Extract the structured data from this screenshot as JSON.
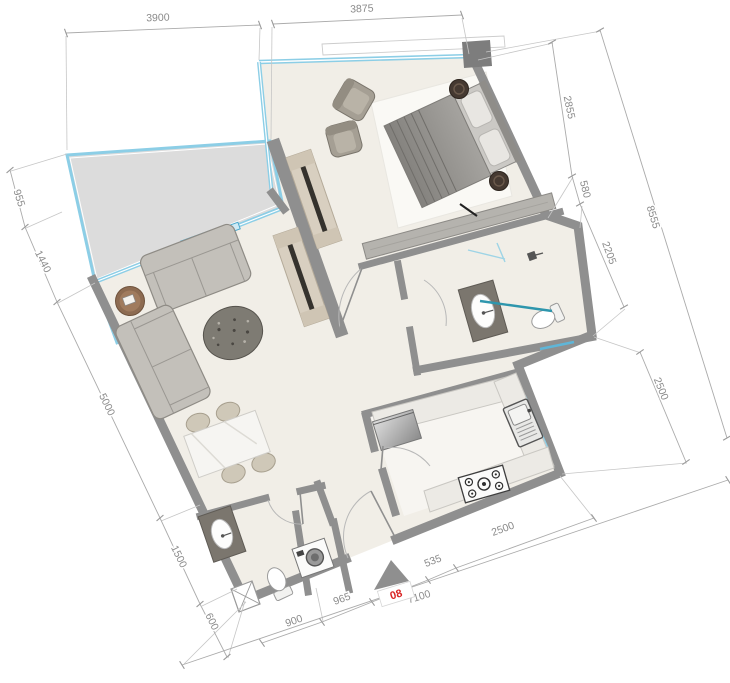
{
  "unit": {
    "number": "08"
  },
  "dims": {
    "top": {
      "d1": "3900",
      "d2": "3875"
    },
    "left": {
      "d1": "955",
      "d2": "1440",
      "d3": "5000",
      "d4": "1500",
      "d5": "600"
    },
    "right": {
      "d1": "2855",
      "d2": "580",
      "d3": "2205",
      "outer": "8555",
      "lower": "2500"
    },
    "bottom": {
      "d1": "900",
      "d2": "965",
      "d3": "535",
      "d4": "2500",
      "outer": "7100"
    }
  },
  "colors": {
    "wall": "#8f8f8f",
    "floor": "#f1eee7",
    "balcony_floor": "#dcdcdc",
    "glass_blue": "#8ccee6",
    "glass_teal": "#2e96ad",
    "dimension_text": "#8a8a8a",
    "unit_number_red": "#d92323",
    "wardrobe_wood": "#d8cfc0"
  },
  "icons": {
    "entry_arrow": "triangle-up",
    "shaft": "crossed-box"
  }
}
